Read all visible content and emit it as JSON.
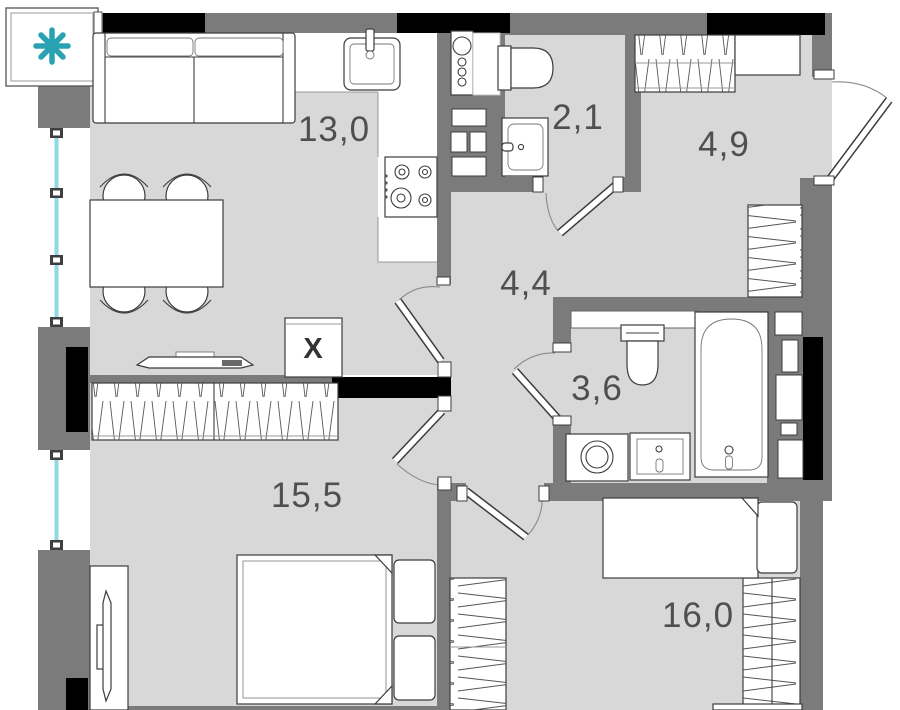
{
  "plan": {
    "title": "apartment-floor-plan",
    "rooms": [
      {
        "id": "kitchen-living",
        "area": "13,0"
      },
      {
        "id": "wc",
        "area": "2,1"
      },
      {
        "id": "entry-hall",
        "area": "4,9"
      },
      {
        "id": "hallway",
        "area": "4,4"
      },
      {
        "id": "bathroom",
        "area": "3,6"
      },
      {
        "id": "bedroom-1",
        "area": "15,5"
      },
      {
        "id": "bedroom-2",
        "area": "16,0"
      }
    ],
    "marks": {
      "duct_label": "X"
    },
    "icons": [
      "snowflake-icon"
    ],
    "colors": {
      "wall": "#7b7b7b",
      "wall-dark": "#000000",
      "floor": "#d8d8d8",
      "outline": "#3c3c3c",
      "glass": "#8ed9e6",
      "ac": "#29a3b1",
      "label": "#4f4f4f"
    }
  }
}
